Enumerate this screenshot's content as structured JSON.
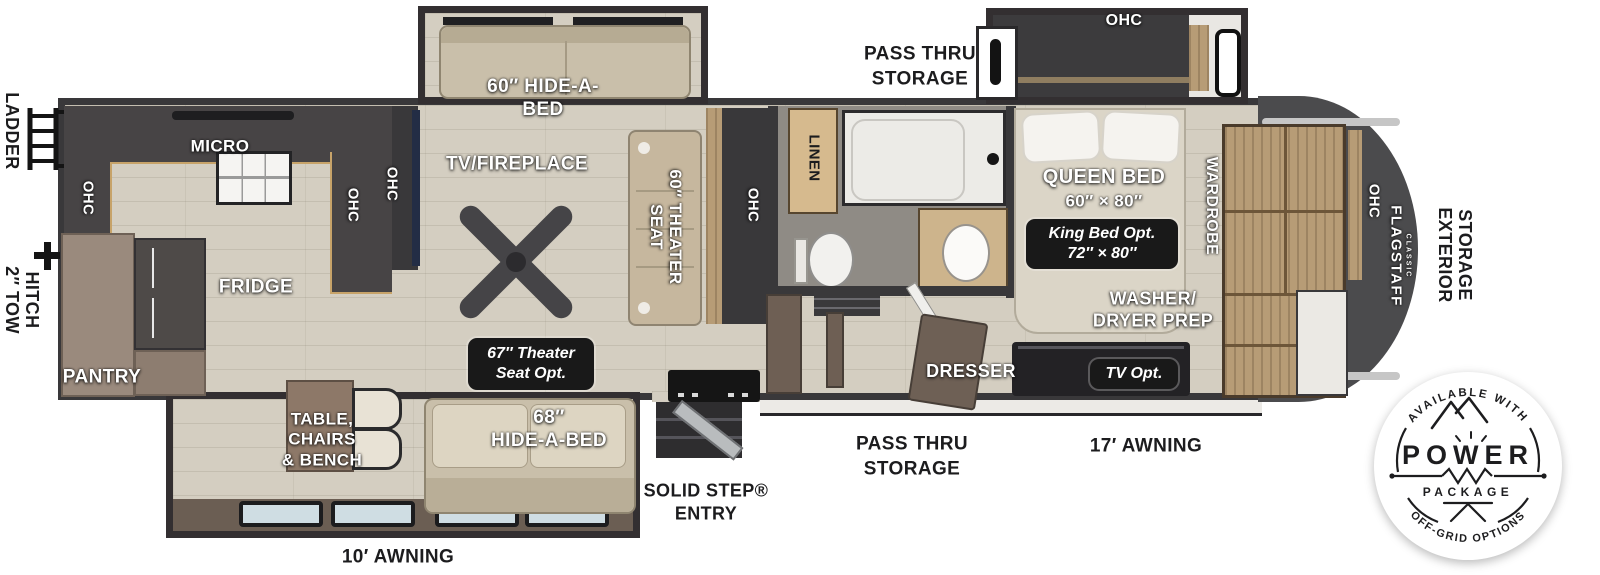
{
  "colors": {
    "wall": "#39383a",
    "floor": "#d4cec1",
    "cabinet_wood": "#b79c76",
    "counter_trim": "#c7a369",
    "front_cap": "#4b4b4d",
    "label_white": "#ffffff",
    "label_black": "#1c1c1e",
    "option_box": "#191919"
  },
  "exterior": {
    "ladder": "LADDER",
    "tow_hitch_l1": "2″ TOW",
    "tow_hitch_l2": "HITCH",
    "pass_thru_top_l1": "PASS THRU",
    "pass_thru_top_l2": "STORAGE",
    "pass_thru_bottom_l1": "PASS THRU",
    "pass_thru_bottom_l2": "STORAGE",
    "awning_rear": "10′ AWNING",
    "awning_front": "17′ AWNING",
    "solid_step_l1": "SOLID STEP®",
    "solid_step_l2": "ENTRY",
    "exterior_storage_l1": "EXTERIOR",
    "exterior_storage_l2": "STORAGE",
    "brand": "FLAGSTAFF",
    "brand_sub": "CLASSIC"
  },
  "kitchen": {
    "micro": "MICRO",
    "fridge": "FRIDGE",
    "pantry": "PANTRY",
    "ohc_rear": "OHC",
    "ohc_peninsula": "OHC",
    "ohc_tv_wall": "OHC"
  },
  "living": {
    "hide_a_bed_60_l1": "60″ HIDE-A-",
    "hide_a_bed_60_l2": "BED",
    "tv_fireplace": "TV/FIREPLACE",
    "theater_seat_l1": "60″ THEATER",
    "theater_seat_l2": "SEAT",
    "ohc": "OHC",
    "theater_opt_l1": "67″ Theater",
    "theater_opt_l2": "Seat Opt.",
    "hide_a_bed_68_l1": "68″",
    "hide_a_bed_68_l2": "HIDE-A-BED",
    "dinette_l1": "TABLE,",
    "dinette_l2": "CHAIRS",
    "dinette_l3": "& BENCH"
  },
  "bath": {
    "linen": "LINEN"
  },
  "bedroom": {
    "ohc_slide": "OHC",
    "queen_l1": "QUEEN BED",
    "queen_l2": "60″ × 80″",
    "king_l1": "King Bed Opt.",
    "king_l2": "72″ × 80″",
    "wardrobe": "WARDROBE",
    "washer_l1": "WASHER/",
    "washer_l2": "DRYER PREP",
    "dresser": "DRESSER",
    "tv_opt": "TV Opt.",
    "ohc_front": "OHC"
  },
  "badge": {
    "top": "AVAILABLE WITH",
    "power": "POWER",
    "package": "PACKAGE",
    "bottom": "OFF-GRID OPTIONS"
  }
}
